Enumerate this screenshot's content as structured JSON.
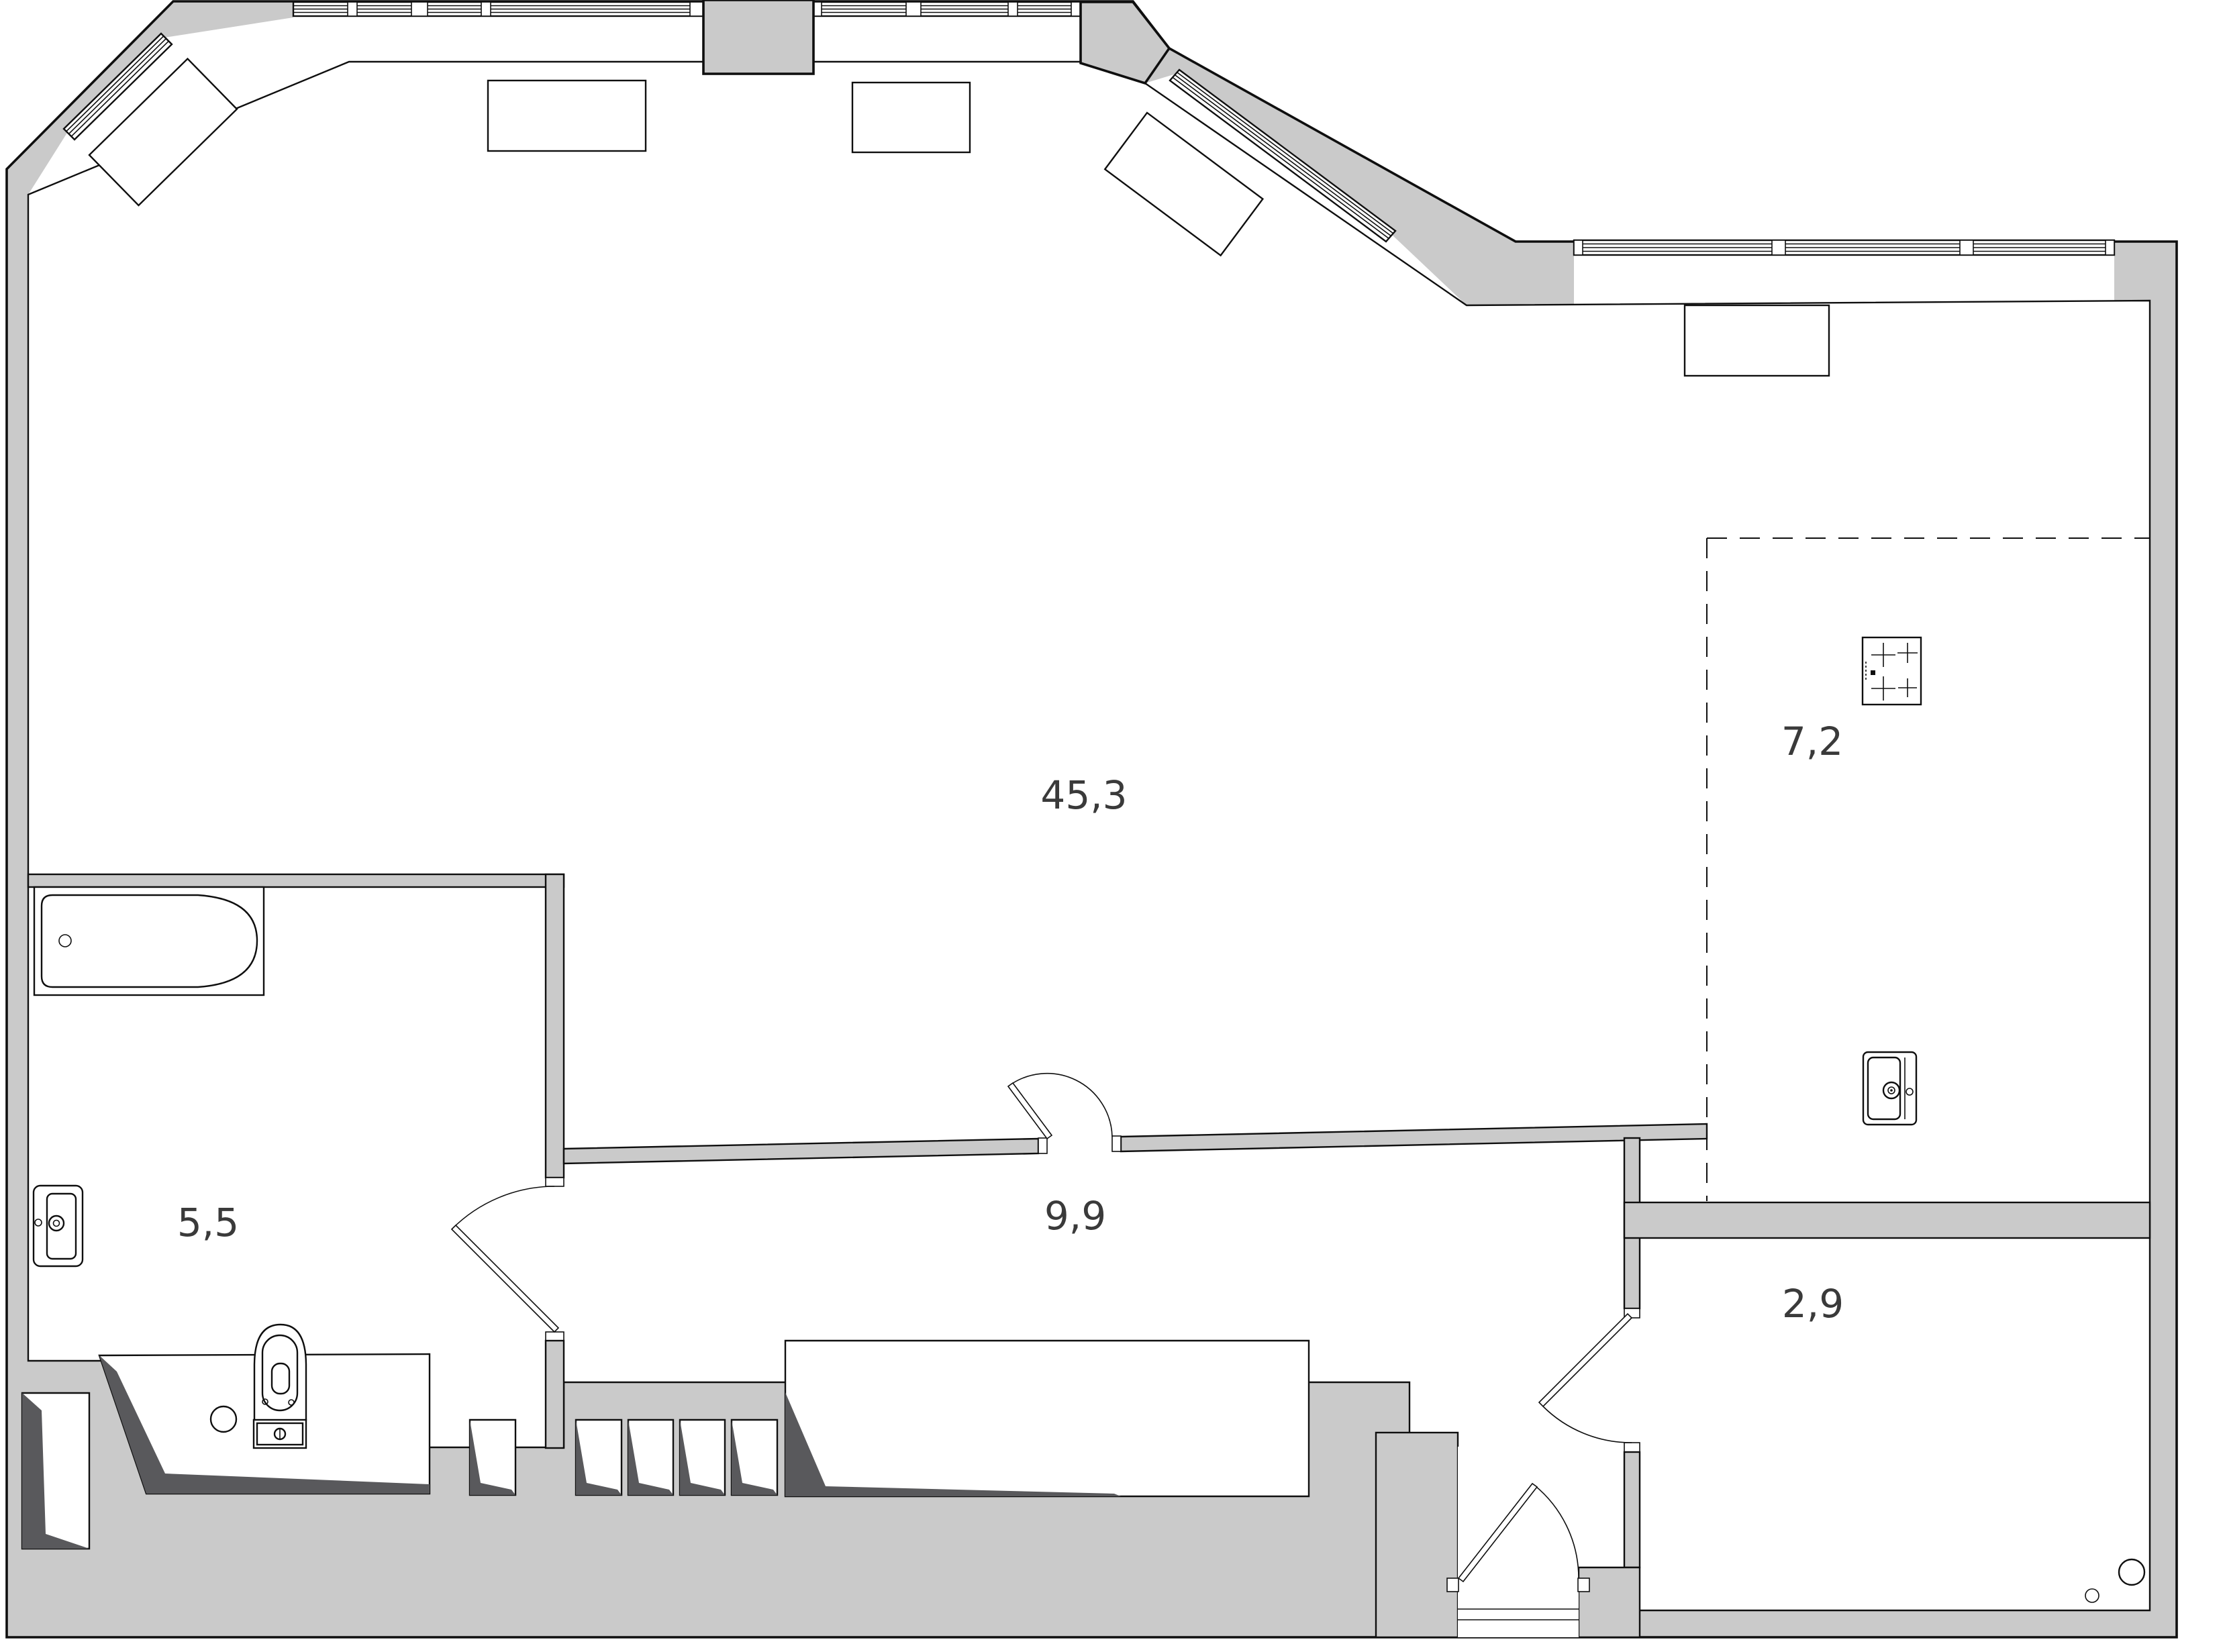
{
  "plan": {
    "title": "apartment-floor-plan",
    "rooms": {
      "living": {
        "name": "living-room",
        "area_label": "45,3"
      },
      "kitchen": {
        "name": "kitchen-zone",
        "area_label": "7,2"
      },
      "bathroom": {
        "name": "bathroom",
        "area_label": "5,5"
      },
      "hallway": {
        "name": "hallway",
        "area_label": "9,9"
      },
      "entry": {
        "name": "entry-room",
        "area_label": "2,9"
      }
    },
    "icons": {
      "bathtub": "bathtub-icon",
      "washbasin": "washbasin-icon",
      "toilet": "toilet-icon",
      "stove": "stove-icon",
      "kitchen_sink": "kitchen-sink-icon",
      "radiator": "radiator-icon",
      "door": "door-swing-icon",
      "window": "window-icon"
    },
    "colors": {
      "wall": "#cacaca",
      "wall_shadow": "#59595c",
      "line": "#0f0f0f",
      "background": "#ffffff",
      "label": "#3a3a3a"
    }
  }
}
